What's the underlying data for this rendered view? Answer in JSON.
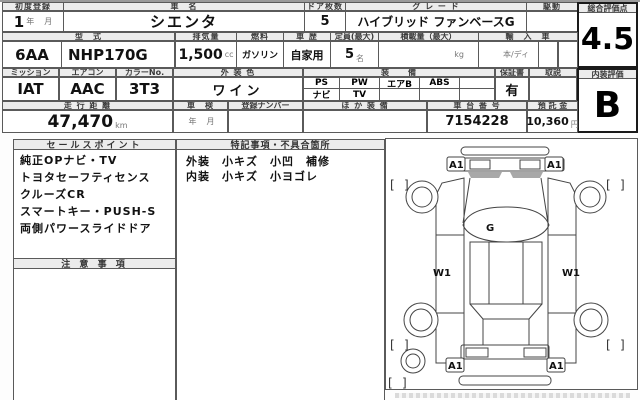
{
  "sheet": {
    "row1": {
      "first_reg_label": "初度登録",
      "first_reg_value": "1",
      "unit_year": "年",
      "unit_month": "月",
      "car_name_label": "車　名",
      "car_name": "シエンタ",
      "doors_label": "ドア枚数",
      "doors": "5",
      "grade_label": "グ レ ー ド",
      "grade": "ハイブリッド ファンベースG",
      "drive_label": "駆動",
      "drive": "",
      "overall_label": "総合評価点",
      "overall_score": "4.5"
    },
    "row2": {
      "model_label": "型　式",
      "model_prefix": "6AA",
      "model_code": "NHP170G",
      "disp_label": "排気量",
      "disp_value": "1,500",
      "disp_unit": "cc",
      "fuel_label": "燃料",
      "fuel": "ガソリン",
      "history_label": "車 歴",
      "history": "自家用",
      "capacity_label": "定員(最大)",
      "capacity": "5",
      "capacity_unit": "名",
      "load_label": "積載量（最大）",
      "load_unit": "kg",
      "import_label": "輸　入　車",
      "import_note": "本/ディ"
    },
    "row3": {
      "mission_label": "ミッション",
      "mission": "IAT",
      "aircon_label": "エアコン",
      "aircon": "AAC",
      "colorno_label": "カラーNo.",
      "colorno": "3T3",
      "color_label": "外 装 色",
      "color": "ワイン",
      "equip_label": "装　　備",
      "equipment_row1": [
        "PS",
        "PW",
        "エアB",
        "ABS",
        ""
      ],
      "equipment_row2": [
        "ナビ",
        "TV",
        "",
        "",
        ""
      ],
      "warranty_label": "保証書",
      "warranty": "有",
      "manual_label": "取説",
      "manual": "",
      "interior_label": "内装評価",
      "interior_score": "B"
    },
    "row4": {
      "mileage_label": "走 行 距 離",
      "mileage": "47,470",
      "mileage_unit": "km",
      "shaken_label": "車　検",
      "shaken_year": "年",
      "shaken_month": "月",
      "reg_label": "登録ナンバー",
      "reg_value": "",
      "other_label": "ほ か 装 備",
      "other_value": "",
      "chassis_label": "車 台 番 号",
      "chassis": "7154228",
      "deposit_label": "預 託 金",
      "deposit": "10,360",
      "deposit_unit": "円"
    },
    "sales": {
      "header": "セールスポイント",
      "items": [
        "純正OPナビ・TV",
        "トヨタセーフティセンス",
        "クルーズCR",
        "スマートキー・PUSH-S",
        "両側パワースライドドア"
      ]
    },
    "caution": {
      "header": "注 意 事 項"
    },
    "notes": {
      "header": "特記事項・不具合箇所",
      "lines": [
        "外装　小キズ　小凹　補修",
        "内装　小キズ　小ヨゴレ"
      ]
    },
    "diagram": {
      "g": "G",
      "w1": "W1",
      "a1": "A1",
      "bo": "[",
      "bc": "]"
    }
  }
}
